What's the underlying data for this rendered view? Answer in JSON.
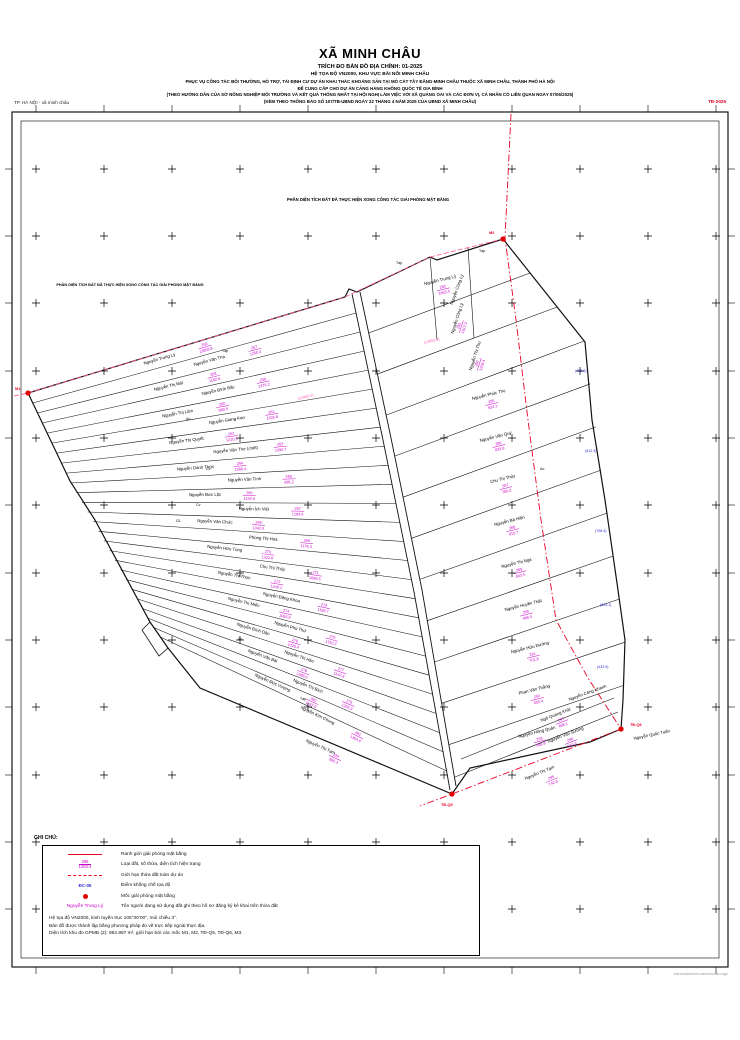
{
  "sheet": {
    "corner_left": "TP. HÀ NỘI - xã minh châu",
    "corner_right": "TĐ-2025",
    "credit": "bandodiachinh-xaminhchau.dgn"
  },
  "title": {
    "commune": "XÃ MINH CHÂU",
    "line1": "TRÍCH ĐO BẢN ĐỒ ĐỊA CHÍNH: 01-2025",
    "line2": "HỆ TỌA ĐỘ VN2000, KHU VỰC BÃI NỔI MINH CHÂU",
    "line3": "PHỤC VỤ CÔNG TÁC BỒI THƯỜNG, HỖ TRỢ, TÁI ĐỊNH CƯ DỰ ÁN KHAI THÁC KHOÁNG SẢN TẠI MỎ CÁT TÂY ĐẰNG-MINH CHÂU THUỘC XÃ MINH CHÂU, THÀNH PHỐ HÀ NỘI",
    "line4": "ĐỂ CUNG CẤP CHO DỰ ÁN CẢNG HÀNG KHÔNG QUỐC TẾ GIA BÌNH",
    "line5": "(THEO HƯỚNG DẪN CỦA SỞ NÔNG NGHIỆP MÔI TRƯỜNG VÀ KẾT QUẢ THỐNG NHẤT TẠI HỘI NGHỊ LÀM VIỆC VỚI XÃ QUẢNG OAI VÀ CÁC ĐƠN VỊ, CÁ NHÂN CÓ LIÊN QUAN NGÀY 07/06/2025)",
    "line6": "(KÈM THEO THÔNG BÁO SỐ 107/TB-UBND NGÀY 22 THÁNG 4 NĂM 2025 CỦA UBND XÃ MINH CHÂU)"
  },
  "annotations": [
    {
      "text": "PHẦN DIỆN TÍCH ĐẤT ĐÃ THỰC HIỆN XONG CÔNG TÁC GIẢI PHÓNG MẶT BẰNG",
      "x": 368,
      "y": 201,
      "size": 4.2
    },
    {
      "text": "PHẦN DIỆN TÍCH ĐẤT ĐÃ THỰC HIỆN XONG CÔNG TÁC GIẢI PHÓNG MẶT BẰNG",
      "x": 130,
      "y": 286,
      "size": 3.8
    }
  ],
  "legend": {
    "heading": "GHI CHÚ:",
    "items": [
      {
        "symbol": "red-line",
        "label": "Ranh giới giải phóng mặt bằng"
      },
      {
        "symbol": "fraction",
        "label": "Loại đất, số thửa, diện tích hiện trạng",
        "sample_top": "256",
        "sample_bottom": "1250.4"
      },
      {
        "symbol": "red-dash",
        "label": "Giới hạn thửa đất toàn dự án"
      },
      {
        "symbol": "control",
        "label": "Điểm khống chế tọa độ",
        "sample": "ĐC-05"
      },
      {
        "symbol": "red-dot",
        "label": "Mốc giải phóng mặt bằng"
      },
      {
        "symbol": "owner-name",
        "label": "Tên người đang sử dụng đất ghi theo hồ sơ đăng ký kê khai trên thửa đất",
        "sample": "Nguyễn Trung Lý"
      }
    ],
    "notes": [
      "Hệ tọa độ VN2000, kinh tuyến trục 105°00'00\", múi chiếu 3°.",
      "Bản đồ được thành lập bằng phương pháp đo vẽ trực tiếp ngoài thực địa.",
      "Diện tích khu đo GPMB (2): 982.887 m², giới hạn bởi các mốc M1, M2, TĐ-Q5, TĐ-Q6, M3."
    ]
  },
  "map": {
    "frame": {
      "outer": [
        12,
        112,
        728,
        967
      ],
      "inner": [
        21,
        121,
        719,
        958
      ]
    },
    "cross_xs": [
      36,
      104,
      172,
      240,
      308,
      376,
      444,
      512,
      580,
      648,
      716
    ],
    "cross_ys": [
      169,
      236,
      303,
      371,
      438,
      505,
      573,
      640,
      707,
      775,
      842,
      909
    ],
    "outline": [
      [
        28,
        393
      ],
      [
        345,
        297
      ],
      [
        349,
        289
      ],
      [
        357,
        292
      ],
      [
        430,
        257
      ],
      [
        437,
        260
      ],
      [
        503,
        239
      ],
      [
        585,
        342
      ],
      [
        592,
        420
      ],
      [
        605,
        500
      ],
      [
        618,
        590
      ],
      [
        625,
        640
      ],
      [
        623,
        700
      ],
      [
        621,
        729
      ],
      [
        590,
        742
      ],
      [
        470,
        768
      ],
      [
        452,
        794
      ],
      [
        200,
        688
      ],
      [
        168,
        648
      ],
      [
        150,
        622
      ],
      [
        95,
        520
      ],
      [
        70,
        481
      ]
    ],
    "step_quad": [
      [
        150,
        622
      ],
      [
        168,
        648
      ],
      [
        159,
        656
      ],
      [
        142,
        630
      ]
    ],
    "strip_left_poly": [
      [
        28,
        393
      ],
      [
        70,
        481
      ],
      [
        150,
        622
      ],
      [
        166,
        646
      ]
    ],
    "strip_right_poly": [
      [
        352,
        294
      ],
      [
        383,
        440
      ],
      [
        414,
        592
      ],
      [
        450,
        790
      ]
    ],
    "road_left_poly": [
      [
        352,
        294
      ],
      [
        383,
        440
      ],
      [
        414,
        592
      ],
      [
        450,
        790
      ]
    ],
    "road_right_poly": [
      [
        360,
        292
      ],
      [
        391,
        438
      ],
      [
        422,
        590
      ],
      [
        456,
        786
      ]
    ],
    "column_left_poly": [
      [
        360,
        292
      ],
      [
        391,
        438
      ],
      [
        422,
        590
      ],
      [
        456,
        786
      ]
    ],
    "column_right_poly": [
      [
        503,
        239
      ],
      [
        585,
        342
      ],
      [
        605,
        500
      ],
      [
        625,
        640
      ],
      [
        621,
        729
      ]
    ],
    "upper_verticals": [
      [
        [
          430,
          257
        ],
        [
          437,
          340
        ]
      ],
      [
        [
          468,
          248
        ],
        [
          474,
          338
        ]
      ]
    ],
    "bottom_lines": [
      [
        [
          455,
          777
        ],
        [
          618,
          712
        ]
      ],
      [
        [
          461,
          759
        ],
        [
          614,
          698
        ]
      ]
    ],
    "strips": [
      {
        "name": "Nguyễn Trung Lý",
        "num": "256",
        "area": "13859.8"
      },
      {
        "name": "Nguyễn Văn Tha",
        "num": "257",
        "area": "1250.4"
      },
      {
        "name": "Nguyễn Thị Mùi",
        "num": "258",
        "area": "1182.6"
      },
      {
        "name": "Nguyễn Đình Bắc",
        "num": "259",
        "area": "1476.2"
      },
      {
        "name": "Nguyễn Thị Lâm",
        "num": "260",
        "area": "980.5"
      },
      {
        "name": "Nguyễn Giang Kao",
        "num": "261",
        "area": "1035.8"
      },
      {
        "name": "Nguyễn Thị Quyết",
        "num": "262",
        "area": "1210.3"
      },
      {
        "name": "Nguyễn Văn Thơ (chết)",
        "num": "263",
        "area": "1390.7"
      },
      {
        "name": "Nguyễn Danh Thức",
        "num": "264",
        "area": "1068.4"
      },
      {
        "name": "Nguyễn Văn Tình",
        "num": "265",
        "area": "995.2"
      },
      {
        "name": "Nguyễn Đức Lộc",
        "num": "266",
        "area": "1150.6"
      },
      {
        "name": "Nguyễn Ích Việt",
        "num": "267",
        "area": "1284.9"
      },
      {
        "name": "Nguyễn Văn Chức",
        "num": "268",
        "area": "1042.0"
      },
      {
        "name": "Phùng Thị Hoa",
        "num": "269",
        "area": "1176.3"
      },
      {
        "name": "Nguyễn Hữu Tùng",
        "num": "270",
        "area": "1322.8"
      },
      {
        "name": "Chu Thị Thủy",
        "num": "271",
        "area": "1089.5"
      },
      {
        "name": "Nguyễn Thị Thực",
        "num": "272",
        "area": "1240.1"
      },
      {
        "name": "Nguyễn Đăng Khoa",
        "num": "273",
        "area": "1158.7"
      },
      {
        "name": "Nguyễn Thị Miến",
        "num": "274",
        "area": "1065.9"
      },
      {
        "name": "Nguyễn Phú Thứ",
        "num": "275",
        "area": "1310.2"
      },
      {
        "name": "Nguyễn Đình Dân",
        "num": "276",
        "area": "1225.4"
      },
      {
        "name": "Nguyễn Thị Hảo",
        "num": "277",
        "area": "1142.8"
      },
      {
        "name": "Nguyễn Văn Bái",
        "num": "278",
        "area": "1098.6"
      },
      {
        "name": "Nguyễn Thị Bích",
        "num": "279",
        "area": "1265.3"
      },
      {
        "name": "Nguyễn Đức Vượng",
        "num": "280",
        "area": "1187.9"
      },
      {
        "name": "Nguyễn Kim Chung",
        "num": "281",
        "area": "1354.6"
      }
    ],
    "column": [
      {
        "name": "Nguyễn Trung Lý",
        "num": "282",
        "area": "2455.6",
        "rot": -14
      },
      {
        "name": "Nguyễn Công Lý",
        "num": "283",
        "area": "1612.3",
        "rot": -72
      },
      {
        "name": "Nguyễn Thị Thu",
        "num": "284",
        "area": "1208.4",
        "rot": -72
      },
      {
        "name": "Nguyễn Phúc Thọ",
        "num": "285",
        "area": "924.1",
        "rot": -14
      },
      {
        "name": "Nguyễn Văn Quý",
        "num": "286",
        "area": "833.9",
        "rot": -14
      },
      {
        "name": "Chu Thị Thủy",
        "num": "287",
        "area": "760.2",
        "rot": -14
      },
      {
        "name": "Nguyễn Bá Hiền",
        "num": "288",
        "area": "915.7",
        "rot": -14
      },
      {
        "name": "Nguyễn Thị Nga",
        "num": "289",
        "area": "842.5",
        "rot": -14
      },
      {
        "name": "Nguyễn Huyền Thật",
        "num": "290",
        "area": "968.0",
        "rot": -14
      },
      {
        "name": "Nguyễn Hữu Đường",
        "num": "291",
        "area": "701.8",
        "rot": -14
      },
      {
        "name": "Phan Văn Thắng",
        "num": "292",
        "area": "655.4",
        "rot": -14
      },
      {
        "name": "Nguyễn Hồng Quân",
        "num": "293",
        "area": "588.9",
        "rot": -14
      }
    ],
    "extra_labels": [
      {
        "name": "Nguyễn Công Lý",
        "x": 458,
        "y": 290,
        "rot": -70
      },
      {
        "name": "Nguyễn Thị Tạm",
        "x": 320,
        "y": 748,
        "rot": 24
      },
      {
        "name": "Nguyễn Thị Tạm",
        "x": 540,
        "y": 774,
        "rot": -22
      },
      {
        "name": "Nguyễn Văn Sướng",
        "x": 566,
        "y": 736,
        "rot": -21
      },
      {
        "name": "Ngô Quang Khải",
        "x": 556,
        "y": 716,
        "rot": -21
      },
      {
        "name": "Nguyễn Công Khanh",
        "x": 588,
        "y": 694,
        "rot": -20
      },
      {
        "name": "Nguyễn Quốc Tuấn",
        "x": 652,
        "y": 736,
        "rot": -12
      }
    ],
    "extra_fractions": [
      {
        "x": 335,
        "y": 758,
        "rot": 24,
        "top": "294",
        "bottom": "865.2"
      },
      {
        "x": 552,
        "y": 780,
        "rot": -22,
        "top": "295",
        "bottom": "742.6"
      },
      {
        "x": 571,
        "y": 742,
        "rot": -21,
        "top": "296",
        "bottom": "510.3"
      },
      {
        "x": 562,
        "y": 722,
        "rot": -21,
        "top": "297",
        "bottom": "498.1"
      }
    ],
    "codes": [
      {
        "text": "Tạp",
        "x": 396,
        "y": 264
      },
      {
        "text": "Tạp",
        "x": 479,
        "y": 252
      },
      {
        "text": "Tạp",
        "x": 222,
        "y": 352
      },
      {
        "text": "Ao",
        "x": 186,
        "y": 420
      },
      {
        "text": "Cv",
        "x": 206,
        "y": 470
      },
      {
        "text": "Cv",
        "x": 196,
        "y": 506
      },
      {
        "text": "G1",
        "x": 176,
        "y": 522
      },
      {
        "text": "Ao",
        "x": 238,
        "y": 640
      },
      {
        "text": "Tạp",
        "x": 300,
        "y": 700
      },
      {
        "text": "Ao",
        "x": 540,
        "y": 470
      }
    ],
    "blue_areas": [
      {
        "text": "(455.6)",
        "x": 575,
        "y": 372
      },
      {
        "text": "(612.3)",
        "x": 585,
        "y": 452
      },
      {
        "text": "(708.4)",
        "x": 595,
        "y": 532
      },
      {
        "text": "(524.1)",
        "x": 600,
        "y": 606
      },
      {
        "text": "(433.9)",
        "x": 597,
        "y": 668
      }
    ],
    "pink_areas": [
      {
        "text": "(13859.8)",
        "x": 424,
        "y": 344
      },
      {
        "text": "(12460.5)",
        "x": 298,
        "y": 400
      }
    ],
    "red_path": [
      [
        511,
        114
      ],
      [
        505,
        238
      ],
      [
        516,
        320
      ],
      [
        528,
        420
      ],
      [
        541,
        520
      ],
      [
        556,
        620
      ],
      [
        588,
        678
      ],
      [
        621,
        729
      ],
      [
        452,
        794
      ],
      [
        420,
        806
      ]
    ],
    "pink_dash": [
      [
        14,
        396
      ],
      [
        28,
        393
      ],
      [
        345,
        297
      ],
      [
        430,
        257
      ],
      [
        503,
        239
      ]
    ],
    "dots": [
      {
        "x": 503,
        "y": 239,
        "label": "M2",
        "lx": 489,
        "ly": 234
      },
      {
        "x": 621,
        "y": 729,
        "label": "TĐ-Q6",
        "lx": 630,
        "ly": 726
      },
      {
        "x": 452,
        "y": 794,
        "label": "TĐ-Q5",
        "lx": 441,
        "ly": 806
      },
      {
        "x": 28,
        "y": 393,
        "label": "M1",
        "lx": 15,
        "ly": 390
      }
    ]
  },
  "colors": {
    "outline": "#111111",
    "red_line": "#e60023",
    "pink_line": "#ff4f9e",
    "magenta": "#cc00cc",
    "pink_area": "#ff5fbf",
    "blue": "#2b2bd0",
    "red_dot": "#e00000"
  }
}
